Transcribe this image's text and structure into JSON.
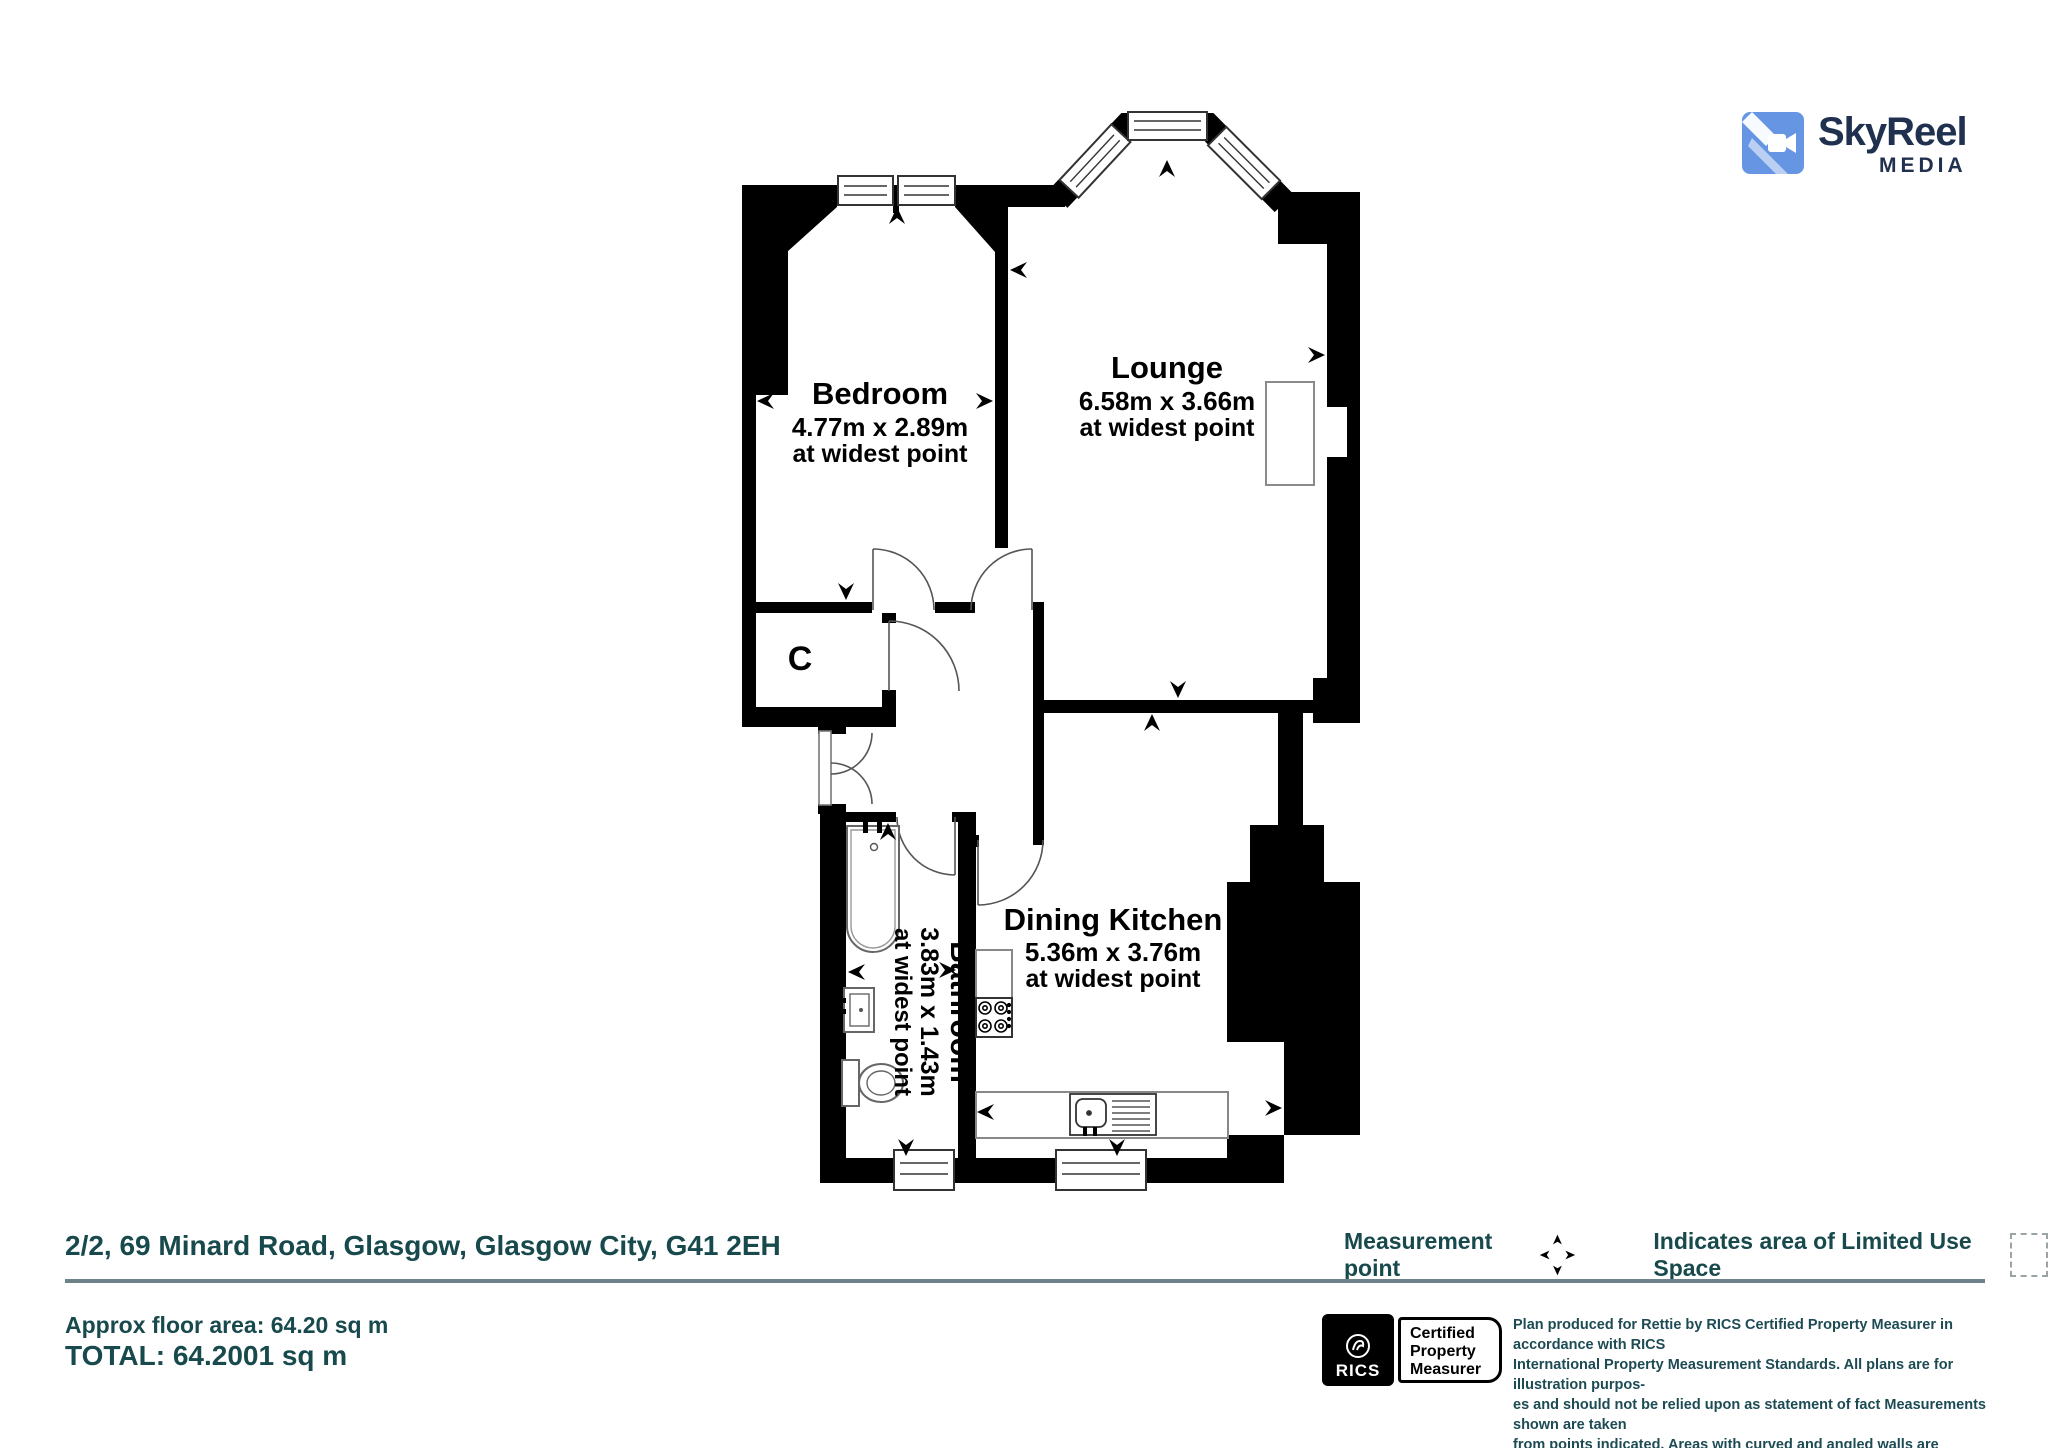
{
  "logo": {
    "name": "SkyReel",
    "sub": "MEDIA"
  },
  "colors": {
    "accent_teal": "#17494d",
    "wall_black": "#000000",
    "logo_blue": "#6695e3",
    "logo_navy": "#20304f",
    "divider_gray": "#6e8389"
  },
  "rooms": {
    "bedroom": {
      "name": "Bedroom",
      "dims": "4.77m x 2.89m",
      "note": "at widest point"
    },
    "lounge": {
      "name": "Lounge",
      "dims": "6.58m x 3.66m",
      "note": "at widest point"
    },
    "dining_kitchen": {
      "name": "Dining Kitchen",
      "dims": "5.36m x 3.76m",
      "note": "at widest point"
    },
    "bathroom": {
      "name": "Bathroom",
      "dims": "3.83m x 1.43m",
      "note": "at widest point"
    },
    "cupboard": {
      "label": "C"
    }
  },
  "footer": {
    "address": "2/2, 69 Minard Road, Glasgow, Glasgow City, G41 2EH",
    "approx_area": "Approx floor area: 64.20 sq m",
    "total": "TOTAL: 64.2001 sq m",
    "legend": {
      "measurement_point": "Measurement point",
      "limited_use": "Indicates area of  Limited Use Space"
    },
    "rics": {
      "org": "RICS",
      "certification_line1": "Certified",
      "certification_line2": "Property",
      "certification_line3": "Measurer"
    },
    "disclaimer": {
      "lines": [
        "Plan produced for Rettie by RICS Certified Property Measurer in accordance with RICS",
        "International Property  Measurement Standards.  All plans are for illustration purpos-",
        "es and should not be relied upon as statement of fact Measurements shown are taken",
        "from points indicated. Areas with curved and angled walls are approximated."
      ]
    }
  }
}
